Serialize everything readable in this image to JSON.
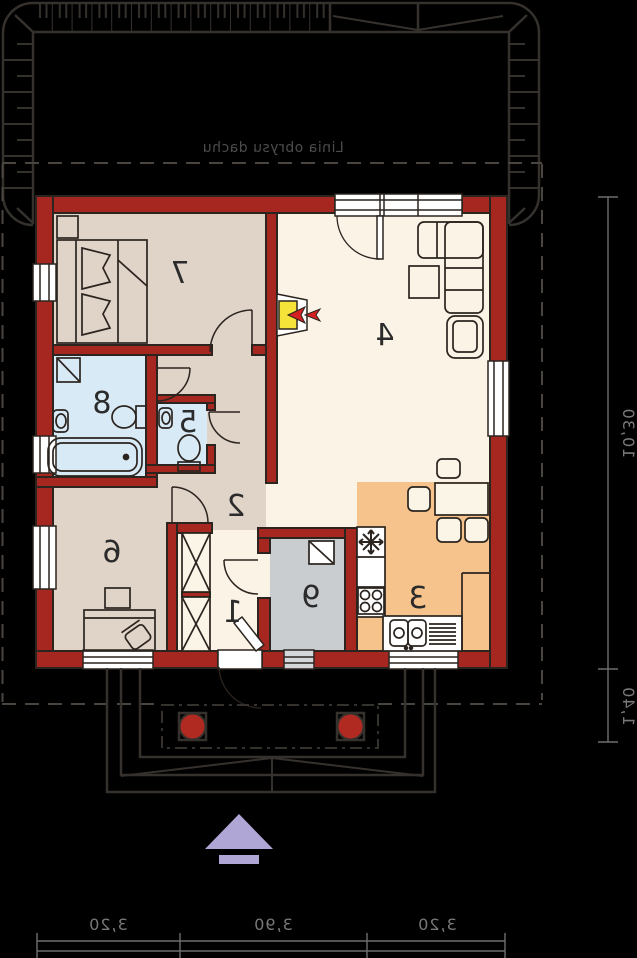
{
  "plan": {
    "roof_label": "Linia obrysu dachu",
    "rooms": {
      "r1": {
        "label": "1"
      },
      "r2": {
        "label": "2"
      },
      "r3": {
        "label": "3"
      },
      "r4": {
        "label": "4"
      },
      "r5": {
        "label": "5"
      },
      "r6": {
        "label": "6"
      },
      "r7": {
        "label": "7"
      },
      "r8": {
        "label": "8"
      },
      "r9": {
        "label": "9"
      }
    },
    "dimensions": {
      "bottom": [
        "3,20",
        "3,90",
        "3,20"
      ],
      "right_height": "10,30",
      "right_porch": "1,40"
    },
    "colors": {
      "background": "#000000",
      "wall_red": "#a6271f",
      "floor_living": "#faf3e6",
      "floor_bedroom": "#e0d3c8",
      "floor_bath": "#d9eaf7",
      "floor_utility": "#cacdd0",
      "floor_kitchen": "#f6c38d",
      "fireplace_yellow": "#f6e33a",
      "flame_red": "#d42020",
      "arrow_purple": "#b0a6d6",
      "line_dark": "#2b241f",
      "roof_line": "#35312d"
    },
    "symbols": [
      "fireplace-icon",
      "snowflake-fridge-icon",
      "hob-icon",
      "sink-icon",
      "bathtub-icon",
      "toilet-icon",
      "washer-icon",
      "wardrobe-x-icon",
      "entrance-arrow-icon"
    ]
  }
}
